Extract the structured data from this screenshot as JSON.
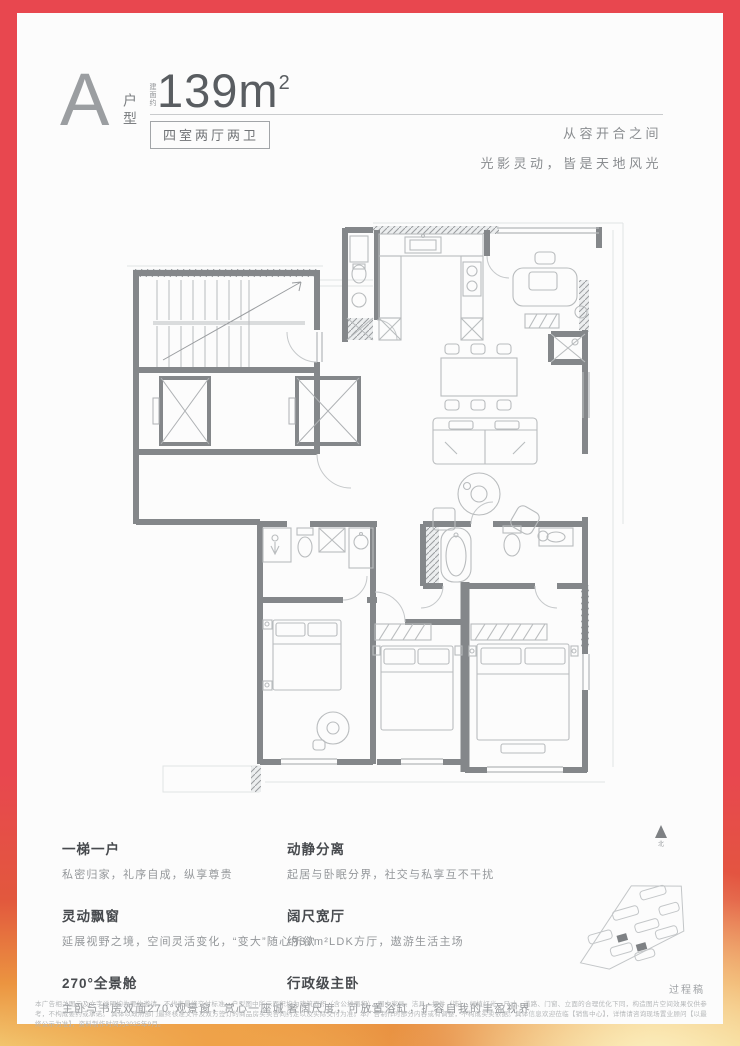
{
  "page": {
    "frame_color": "#e8474f",
    "card_color": "#fcfcfc"
  },
  "header": {
    "unit_letter": "A",
    "unit_type_label": "户型",
    "area_prefix": "建面约",
    "area_number": "139m",
    "area_superscript": "2",
    "layout_spec": "四室两厅两卫",
    "tagline_line1": "从容开合之间",
    "tagline_line2": "光影灵动，皆是天地风光"
  },
  "features": {
    "left": [
      {
        "title": "一梯一户",
        "desc": "私密归家，礼序自成，纵享尊贵"
      },
      {
        "title": "灵动飘窗",
        "desc": "延展视野之境，空间灵活变化，“变大”随心所欲"
      },
      {
        "title": "270°全景舱",
        "desc": "主卧与书房双面270°观景窗，赏心一座城"
      }
    ],
    "right": [
      {
        "title": "动静分离",
        "desc": "起居与卧眠分界，社交与私享互不干扰"
      },
      {
        "title": "阔尺宽厅",
        "desc": "约37m²LDK方厅，遨游生活主场"
      },
      {
        "title": "行政级主卧",
        "desc": "奢阔尺度，可放置浴缸，扩容自我的丰盈视界"
      }
    ]
  },
  "compass": {
    "north_label": "北"
  },
  "footer": {
    "draft_label": "过程稿",
    "disclaimer_line1": "本广告相关图示及文字说明均为要约邀请，不代表最终交付标准。户型图中所示面积均为建筑面积（含公摊面积），图中家具、洁具、摆件（饰）、绿植灯光、尺寸、道路、门窗、立面的合理优化下同，构造图片空间效果仅供参考，不构成要约或承诺。",
    "disclaimer_line2": "具体以政府部门最终核准文件及双方签订的商品房买卖合同约定以及实际交付为准。本广告制作时部分内容或有调整，不构成买卖依据。具体信息欢迎莅临【销售中心】，详情请咨询现场置业顾问【以最终公示为准】，资料制作时间为2025年9月。"
  }
}
